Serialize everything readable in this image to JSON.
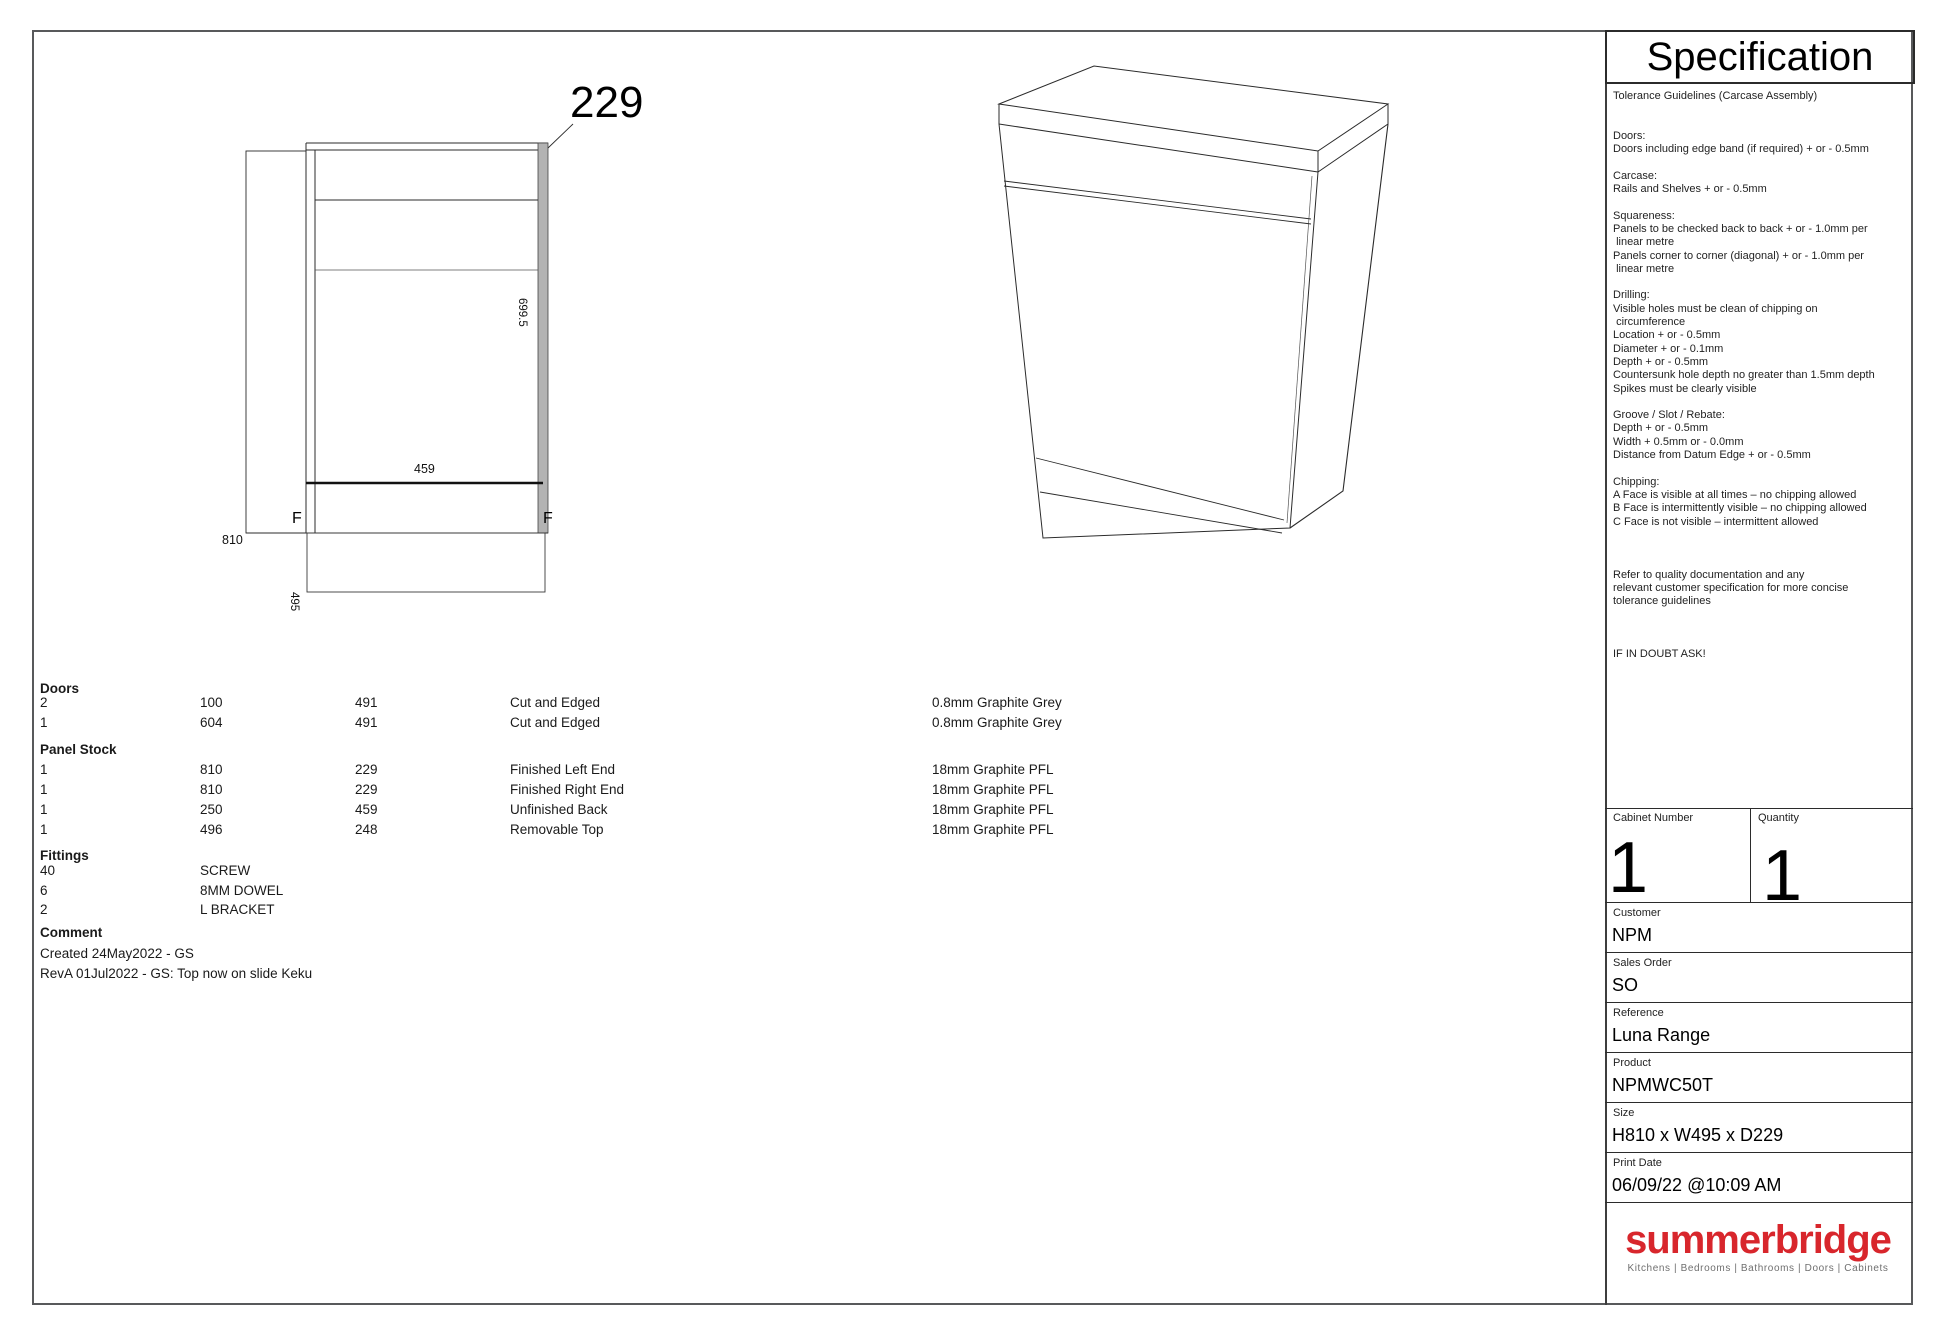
{
  "spec_panel": {
    "title": "Specification",
    "tolerance_text": [
      "Tolerance Guidelines (Carcase Assembly)",
      "",
      "",
      "Doors:",
      "Doors including edge band (if required) + or - 0.5mm",
      "",
      "Carcase:",
      "Rails and Shelves + or - 0.5mm",
      "",
      "Squareness:",
      "Panels to be checked back to back + or - 1.0mm per",
      " linear metre",
      "Panels corner to corner (diagonal) + or - 1.0mm per",
      " linear metre",
      "",
      "Drilling:",
      "Visible holes must be clean of chipping on",
      " circumference",
      "Location + or - 0.5mm",
      "Diameter + or - 0.1mm",
      "Depth + or - 0.5mm",
      "Countersunk hole depth no greater than 1.5mm depth",
      "Spikes must be clearly visible",
      "",
      "Groove / Slot / Rebate:",
      "Depth + or - 0.5mm",
      "Width + 0.5mm or - 0.0mm",
      "Distance from Datum Edge + or - 0.5mm",
      "",
      "Chipping:",
      "A Face is visible at all times – no chipping allowed",
      "B Face is intermittently visible – no chipping allowed",
      "C Face is not visible – intermittent allowed",
      "",
      "",
      "",
      "Refer to quality documentation and any",
      "relevant customer specification for more concise",
      "tolerance guidelines",
      "",
      "",
      "",
      "IF IN DOUBT ASK!"
    ],
    "fields": {
      "cabinet_number_label": "Cabinet Number",
      "cabinet_number_value": "1",
      "quantity_label": "Quantity",
      "quantity_value": "1",
      "customer_label": "Customer",
      "customer_value": "NPM",
      "sales_order_label": "Sales Order",
      "sales_order_value": "SO",
      "reference_label": "Reference",
      "reference_value": "Luna Range",
      "product_label": "Product",
      "product_value": "NPMWC50T",
      "size_label": "Size",
      "size_value": "H810 x W495 x D229",
      "print_date_label": "Print Date",
      "print_date_value": "06/09/22 @10:09 AM"
    },
    "logo": {
      "name": "summerbridge",
      "tagline": "Kitchens | Bedrooms | Bathrooms | Doors | Cabinets",
      "color": "#d8262c"
    }
  },
  "drawing": {
    "dim_depth_top": "229",
    "dim_door_height": "699.5",
    "dim_inner_width": "459",
    "dim_total_height": "810",
    "dim_total_width": "495",
    "face_mark_left": "F",
    "face_mark_right": "F",
    "edgeband_color": "#b3b3b3"
  },
  "parts": {
    "sections": [
      {
        "title": "Doors",
        "rows": [
          [
            "2",
            "100",
            "491",
            "Cut and Edged",
            "0.8mm Graphite Grey"
          ],
          [
            "1",
            "604",
            "491",
            "Cut and Edged",
            "0.8mm Graphite Grey"
          ]
        ]
      },
      {
        "title": "Panel Stock",
        "rows": [
          [
            "1",
            "810",
            "229",
            "Finished Left End",
            "18mm Graphite PFL"
          ],
          [
            "1",
            "810",
            "229",
            "Finished Right End",
            "18mm Graphite PFL"
          ],
          [
            "1",
            "250",
            "459",
            "Unfinished Back",
            "18mm Graphite PFL"
          ],
          [
            "1",
            "496",
            "248",
            "Removable Top",
            "18mm Graphite PFL"
          ]
        ]
      },
      {
        "title": "Fittings",
        "rows": [
          [
            "40",
            "SCREW"
          ],
          [
            "6",
            "8MM DOWEL"
          ],
          [
            "2",
            "L BRACKET"
          ]
        ]
      }
    ],
    "comment": {
      "title": "Comment",
      "lines": [
        "Created 24May2022 - GS",
        "RevA 01Jul2022 - GS: Top now on slide Keku"
      ]
    }
  }
}
